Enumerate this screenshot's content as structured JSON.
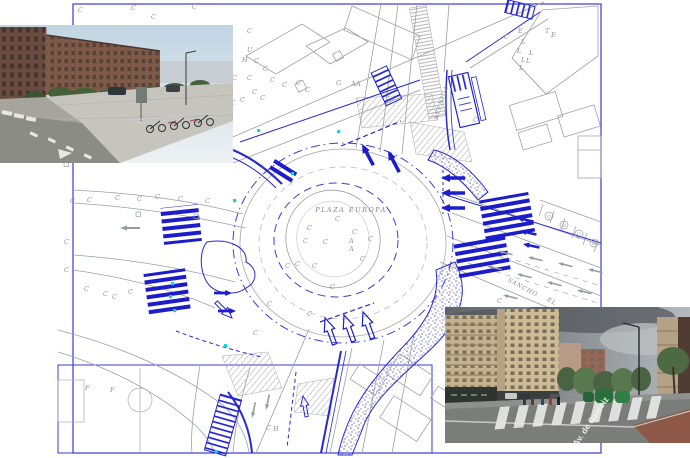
{
  "plan": {
    "labels": {
      "plaza": "PLAZA EUROPA",
      "avenida": "AVENIDA",
      "sancho": "SANCHO",
      "sancho2": "EL"
    },
    "colors": {
      "line_blue": "#2323cf",
      "line_gray": "#9aa0a6",
      "signal_cyan": "#19d3dc",
      "letter_gray": "#8f8f9c"
    },
    "tree_symbols": [
      {
        "t": "O",
        "x": 549,
        "y": 216
      },
      {
        "t": "H",
        "x": 564,
        "y": 225
      },
      {
        "t": "O",
        "x": 579,
        "y": 234
      },
      {
        "t": "H",
        "x": 594,
        "y": 243
      }
    ],
    "scatter_letters": [
      {
        "t": "C",
        "x": 70,
        "y": 203
      },
      {
        "t": "C",
        "x": 87,
        "y": 202
      },
      {
        "t": "C",
        "x": 115,
        "y": 200
      },
      {
        "t": "C",
        "x": 137,
        "y": 201
      },
      {
        "t": "C",
        "x": 155,
        "y": 199
      },
      {
        "t": "C",
        "x": 178,
        "y": 201
      },
      {
        "t": "C",
        "x": 205,
        "y": 203
      },
      {
        "t": "C",
        "x": 64,
        "y": 244
      },
      {
        "t": "C",
        "x": 64,
        "y": 272
      },
      {
        "t": "C",
        "x": 84,
        "y": 291
      },
      {
        "t": "C",
        "x": 103,
        "y": 296
      },
      {
        "t": "C",
        "x": 112,
        "y": 299
      },
      {
        "t": "C",
        "x": 128,
        "y": 294
      },
      {
        "t": "C",
        "x": 78,
        "y": 12
      },
      {
        "t": "C",
        "x": 131,
        "y": 10
      },
      {
        "t": "C",
        "x": 151,
        "y": 19
      },
      {
        "t": "C",
        "x": 192,
        "y": 9
      },
      {
        "t": "C",
        "x": 247,
        "y": 33
      },
      {
        "t": "U",
        "x": 247,
        "y": 52
      },
      {
        "t": "H",
        "x": 242,
        "y": 62
      },
      {
        "t": "C",
        "x": 254,
        "y": 63
      },
      {
        "t": "C",
        "x": 263,
        "y": 71
      },
      {
        "t": "C",
        "x": 232,
        "y": 80
      },
      {
        "t": "C",
        "x": 247,
        "y": 80
      },
      {
        "t": "C",
        "x": 270,
        "y": 82
      },
      {
        "t": "C",
        "x": 282,
        "y": 87
      },
      {
        "t": "C",
        "x": 296,
        "y": 85
      },
      {
        "t": "C",
        "x": 305,
        "y": 92
      },
      {
        "t": "C",
        "x": 252,
        "y": 94
      },
      {
        "t": "C",
        "x": 240,
        "y": 102
      },
      {
        "t": "C",
        "x": 260,
        "y": 100
      },
      {
        "t": "C",
        "x": 230,
        "y": 105
      },
      {
        "t": "C",
        "x": 222,
        "y": 112
      },
      {
        "t": "G",
        "x": 336,
        "y": 85
      },
      {
        "t": "A",
        "x": 351,
        "y": 86
      },
      {
        "t": "A",
        "x": 356,
        "y": 86
      },
      {
        "t": "C",
        "x": 504,
        "y": 39
      },
      {
        "t": "E",
        "x": 518,
        "y": 33
      },
      {
        "t": "T",
        "x": 545,
        "y": 33
      },
      {
        "t": "E",
        "x": 551,
        "y": 37
      },
      {
        "t": "L",
        "x": 521,
        "y": 44
      },
      {
        "t": "L",
        "x": 517,
        "y": 53
      },
      {
        "t": "L",
        "x": 529,
        "y": 55
      },
      {
        "t": "L",
        "x": 521,
        "y": 62
      },
      {
        "t": "L",
        "x": 526,
        "y": 63
      },
      {
        "t": "L",
        "x": 519,
        "y": 70
      },
      {
        "t": "C",
        "x": 335,
        "y": 221
      },
      {
        "t": "C",
        "x": 352,
        "y": 234
      },
      {
        "t": "C",
        "x": 303,
        "y": 243
      },
      {
        "t": "C",
        "x": 323,
        "y": 244
      },
      {
        "t": "C",
        "x": 368,
        "y": 241
      },
      {
        "t": "C",
        "x": 295,
        "y": 266
      },
      {
        "t": "C",
        "x": 312,
        "y": 268
      },
      {
        "t": "C",
        "x": 360,
        "y": 261
      },
      {
        "t": "C",
        "x": 285,
        "y": 268
      },
      {
        "t": "C",
        "x": 330,
        "y": 289
      },
      {
        "t": "A",
        "x": 349,
        "y": 243
      },
      {
        "t": "A",
        "x": 349,
        "y": 251
      },
      {
        "t": "C",
        "x": 307,
        "y": 230
      },
      {
        "t": "C",
        "x": 267,
        "y": 306
      },
      {
        "t": "C",
        "x": 253,
        "y": 335
      },
      {
        "t": "C",
        "x": 473,
        "y": 122
      },
      {
        "t": "C",
        "x": 497,
        "y": 303
      },
      {
        "t": "F",
        "x": 85,
        "y": 390
      },
      {
        "t": "F",
        "x": 110,
        "y": 392
      },
      {
        "t": "C",
        "x": 266,
        "y": 430
      },
      {
        "t": "H",
        "x": 273,
        "y": 431
      },
      {
        "t": "C",
        "x": 307,
        "y": 316
      }
    ]
  },
  "photos": {
    "bottom_right": {
      "street_label": "Av. de Gasteiz"
    }
  }
}
